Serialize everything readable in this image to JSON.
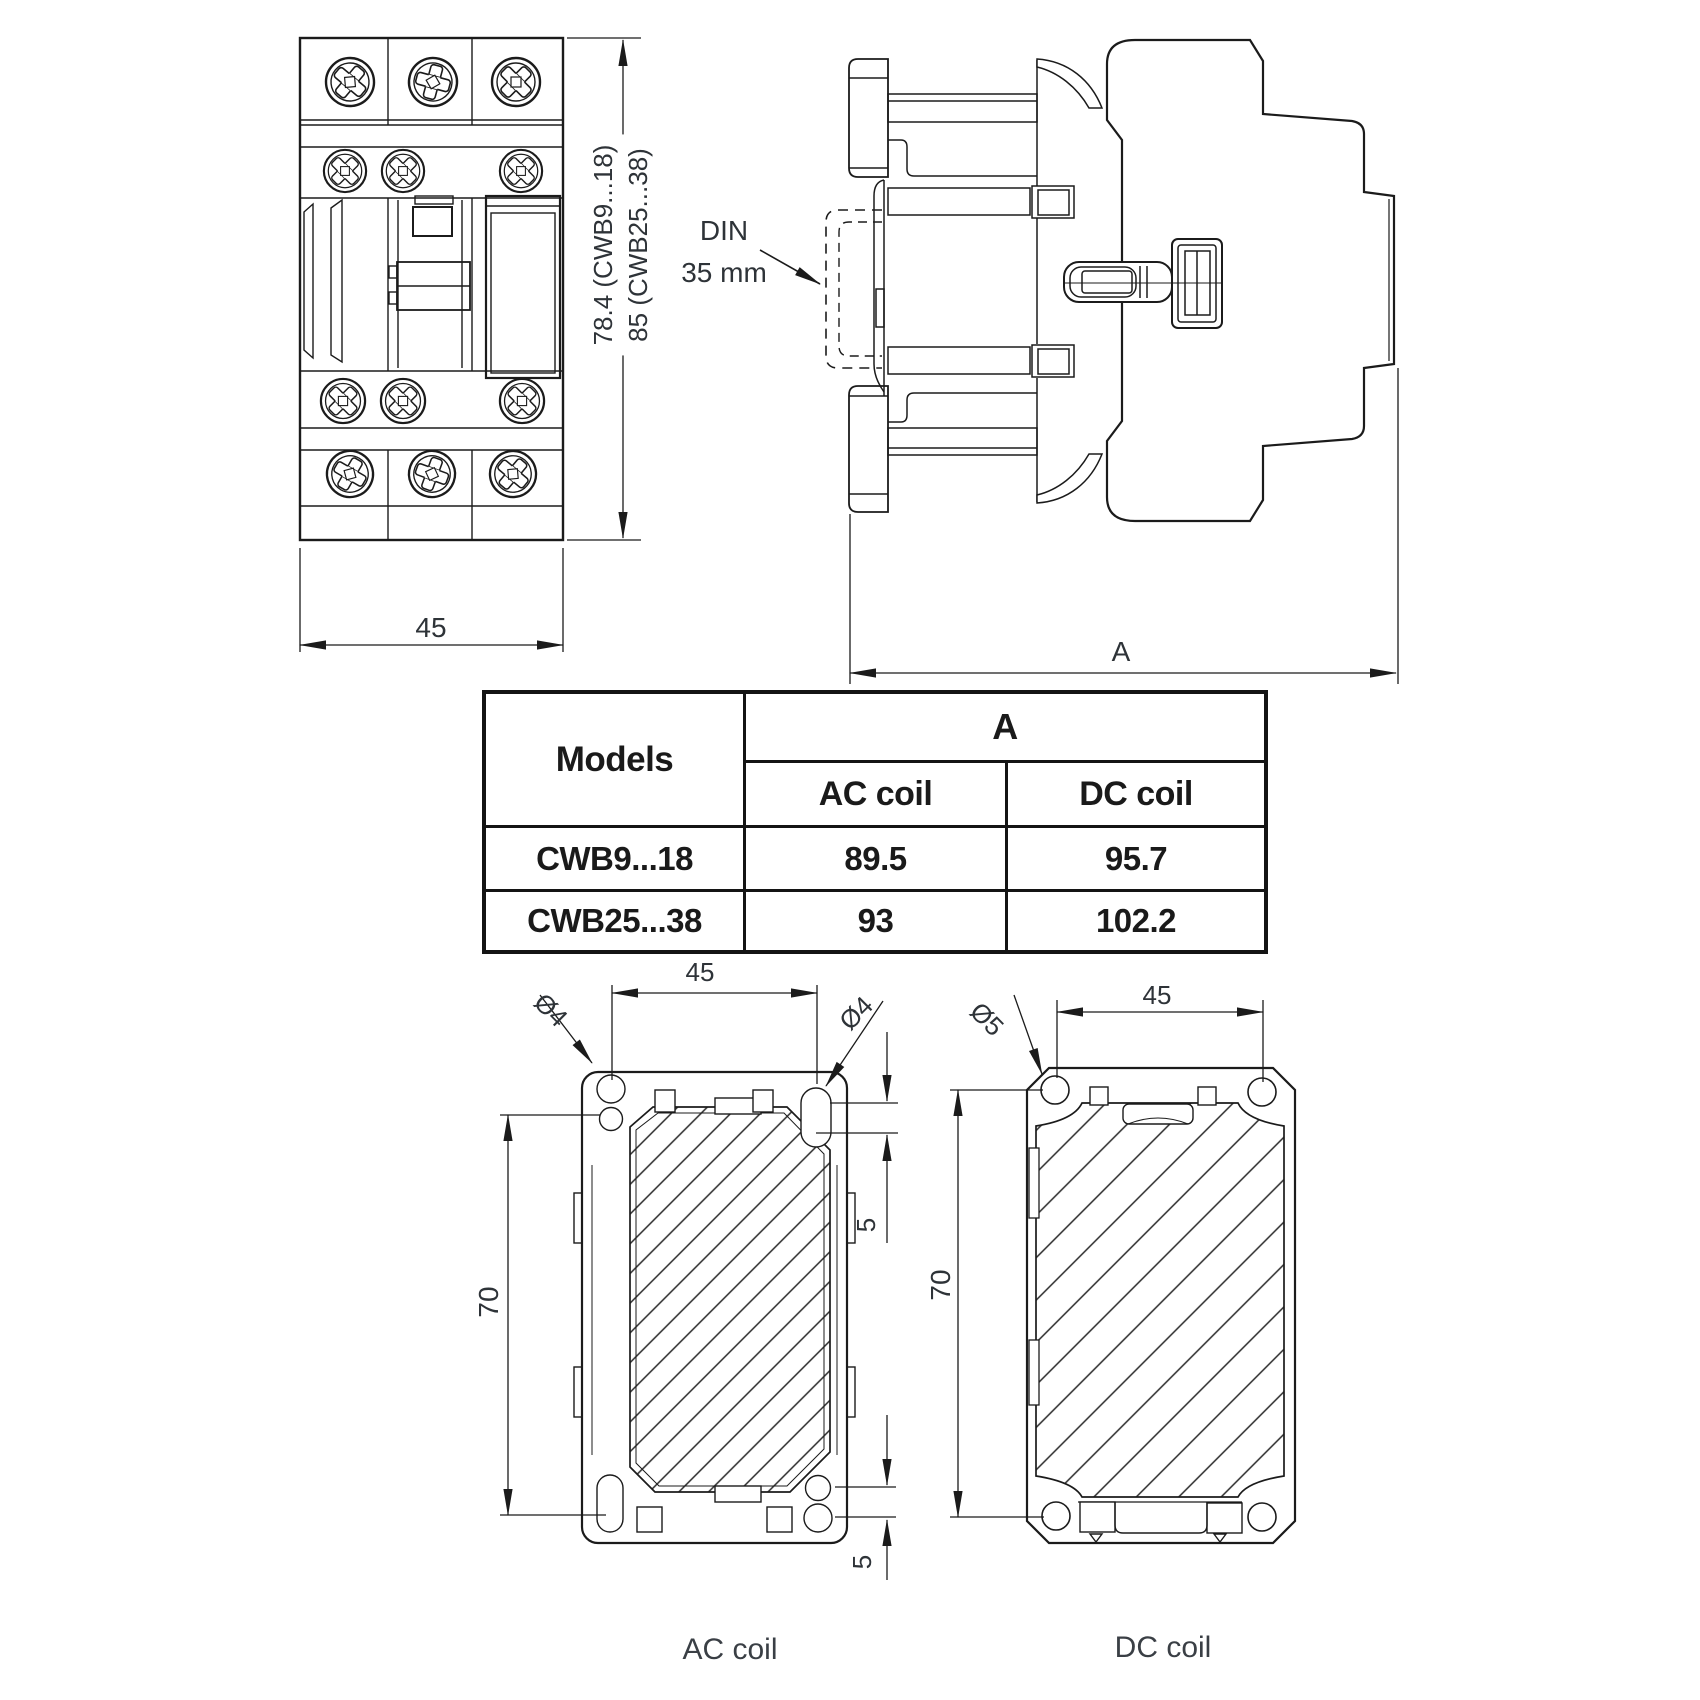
{
  "colors": {
    "line": "#1b1b1b",
    "dim_text": "#2e3338",
    "caption": "#3a3f45"
  },
  "front_view": {
    "width_label": "45",
    "height_label_line1": "78.4 (CWB9...18)",
    "height_label_line2": "85 (CWB25...38)"
  },
  "side_view": {
    "din_label_line1": "DIN",
    "din_label_line2": "35 mm",
    "width_label": "A"
  },
  "table": {
    "models_header": "Models",
    "a_header": "A",
    "ac_header": "AC coil",
    "dc_header": "DC coil",
    "rows": [
      {
        "model": "CWB9...18",
        "ac": "89.5",
        "dc": "95.7"
      },
      {
        "model": "CWB25...38",
        "ac": "93",
        "dc": "102.2"
      }
    ]
  },
  "ac_drawing": {
    "caption": "AC coil",
    "width_label": "45",
    "height_label": "70",
    "hole_label_left": "Ø4",
    "hole_label_right": "Ø4",
    "pitch_label_top": "5",
    "pitch_label_bottom": "5"
  },
  "dc_drawing": {
    "caption": "DC coil",
    "width_label": "45",
    "height_label": "70",
    "hole_label": "Ø5"
  }
}
